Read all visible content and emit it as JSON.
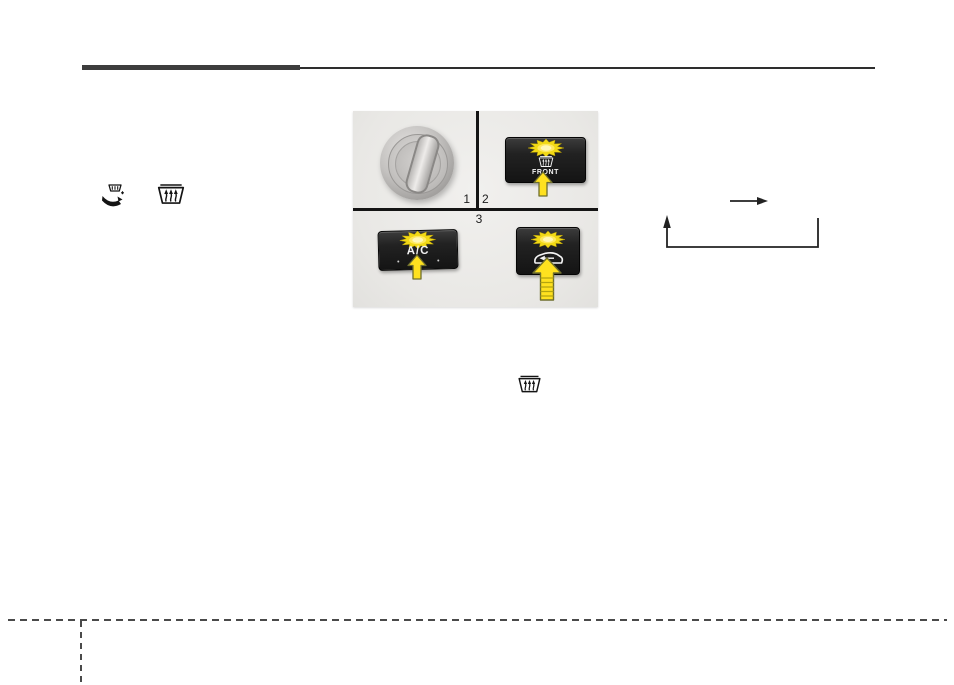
{
  "page": {
    "kind": "owner-manual-page",
    "background": "#ffffff"
  },
  "header": {
    "rule_color": "#3d3d3d"
  },
  "figure": {
    "background": "#ebeae7",
    "callouts": {
      "knob": "1",
      "front_defrost": "2",
      "ac": "3"
    },
    "buttons": {
      "front_defrost": {
        "label": "FRONT",
        "icon": "front-windshield-defrost-icon"
      },
      "ac": {
        "label": "A/C"
      },
      "recirculation": {
        "icon": "recirculated-air-icon"
      }
    },
    "knob": {
      "name": "mode-selection-knob"
    },
    "indicator_color": "#ffe11f",
    "arrow_color": "#ffe11f"
  },
  "inline_icons": {
    "left_icon_1": "defrost-mode-icon",
    "left_icon_2": "front-windshield-defrost-icon",
    "mid_icon": "front-windshield-defrost-icon"
  },
  "flow_diagram": {
    "name": "mode-cycle-arrows",
    "color": "#222222"
  },
  "footer": {
    "dash_color": "#4a4a4a"
  }
}
